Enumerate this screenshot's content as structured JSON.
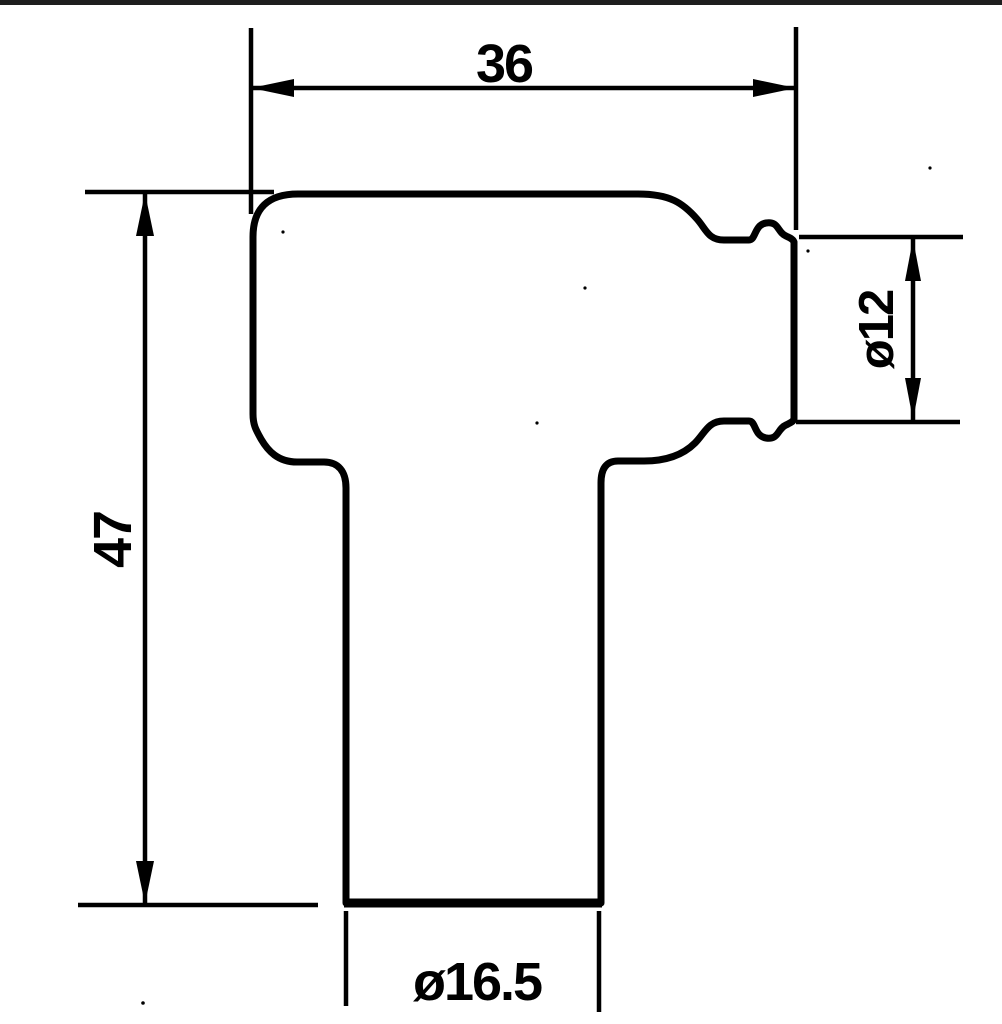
{
  "figure": {
    "kind": "dimensioned-technical-drawing",
    "subject": "spark-plug-cap-profile"
  },
  "colors": {
    "ink": "#000000",
    "paper": "#ffffff",
    "top_border_bar": "#1e1e1e"
  },
  "dimensions": {
    "top_width": "36",
    "left_height": "47",
    "right_diameter": "ø12",
    "bottom_diameter": "ø16.5"
  }
}
